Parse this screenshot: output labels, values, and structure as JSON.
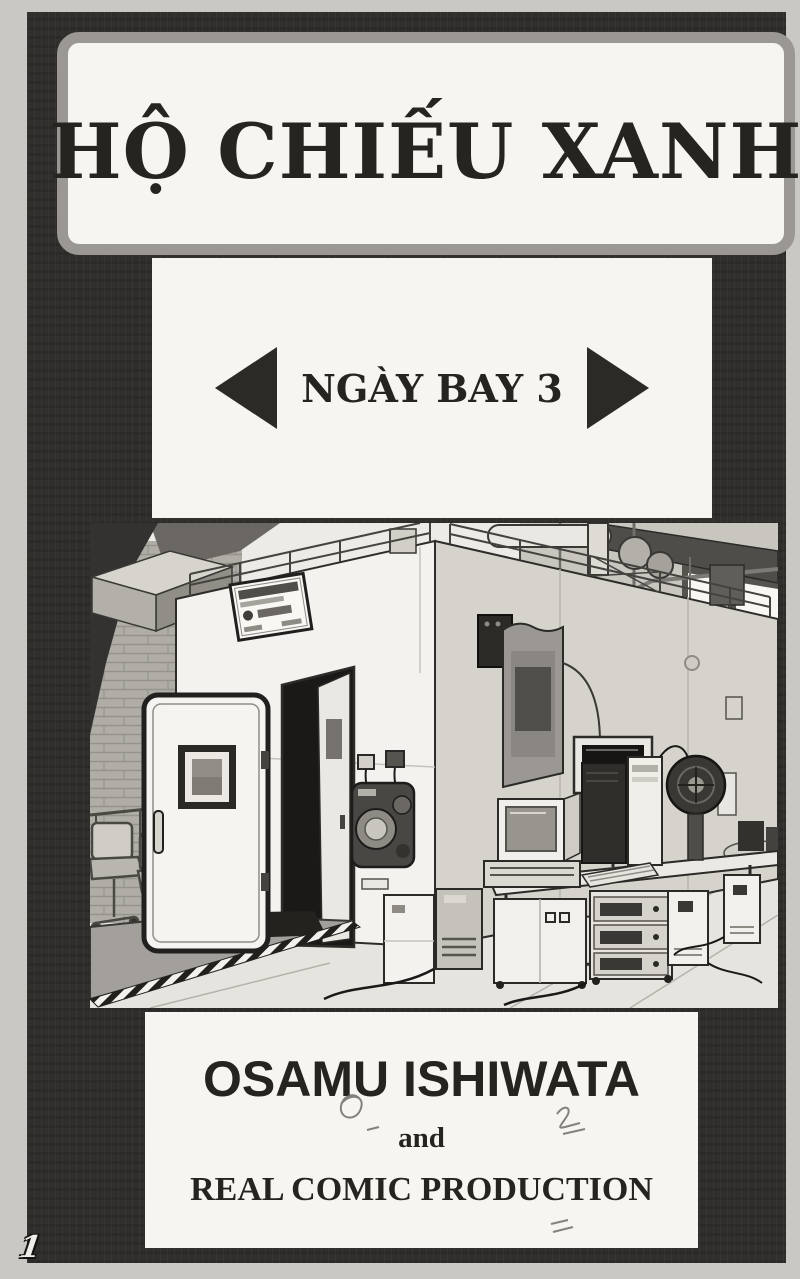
{
  "page": {
    "number": "1"
  },
  "title_box": {
    "title": "HỘ CHIẾU XANH"
  },
  "chapter_box": {
    "label": "NGÀY BAY 3",
    "icons": {
      "left": "left-triangle-arrow",
      "right": "right-triangle-arrow"
    }
  },
  "illustration": {
    "description": "Black-and-white manga drawing of an industrial test room: a large white walk-in chamber with its heavy gasketed door swung open, a small viewing window in the door, a round-knob control panel beside the dark doorway, guard railings and ducts on the roof, a brick wall and office chairs at left, a hazard-striped ramp with a dark floor mat in front of the door, and at right a computer desk with CRT monitor, drive stacks, cabinets and standalone tower units connected by floor cables."
  },
  "credits_box": {
    "author": "OSAMU ISHIWATA",
    "connector": "and",
    "studio": "REAL COMIC PRODUCTION"
  },
  "colors": {
    "page_margin": "#c9c8c5",
    "frame": "#312f2c",
    "box_background": "#f6f5f2",
    "border_gray": "#9b9894",
    "ink": "#26241f"
  }
}
